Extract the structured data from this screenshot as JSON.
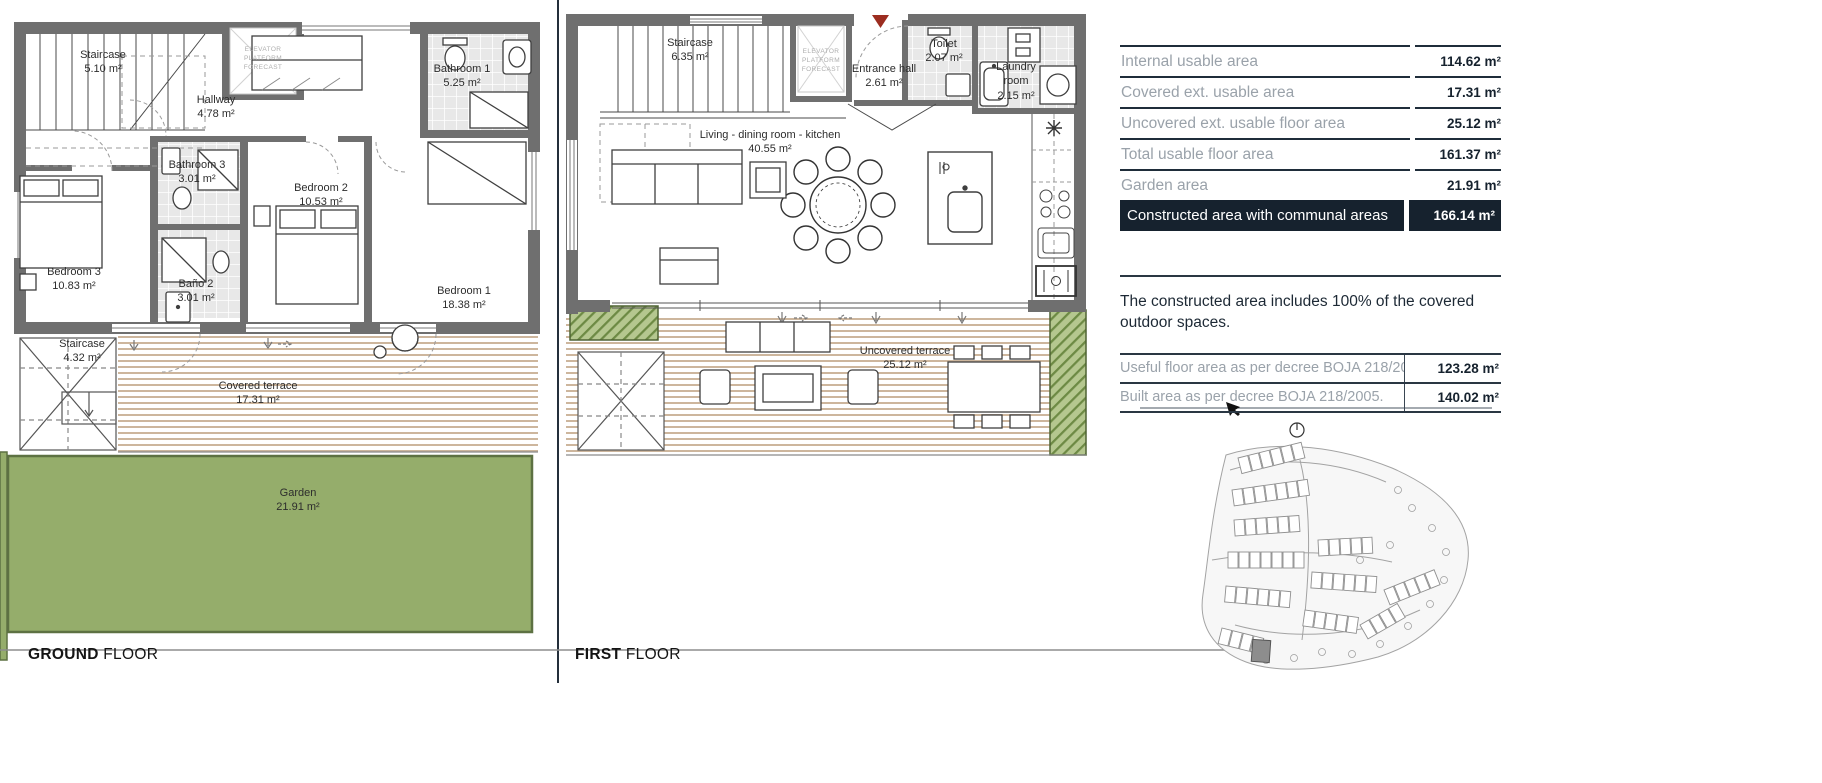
{
  "colors": {
    "navy": "#16222e",
    "table_label_gray": "#9aa2aa",
    "wall_gray": "#6f6f6f",
    "deck_tan": "#cdb69d",
    "garden_green": "#95ad6b",
    "planter_green": "#6d8a44",
    "marker_red": "#9c2d20"
  },
  "ground_floor": {
    "title": {
      "bold": "GROUND",
      "regular": " FLOOR"
    },
    "elevator_note": "ELEVATOR\nPLATFORM\nFORECAST",
    "rooms": [
      {
        "name": "Staircase",
        "area": "5.10 m²"
      },
      {
        "name": "Hallway",
        "area": "4.78 m²"
      },
      {
        "name": "Bathroom 1",
        "area": "5.25 m²"
      },
      {
        "name": "Bathroom 3",
        "area": "3.01 m²"
      },
      {
        "name": "Bedroom 2",
        "area": "10.53 m²"
      },
      {
        "name": "Bedroom 3",
        "area": "10.83 m²"
      },
      {
        "name": "Baño 2",
        "area": "3.01 m²"
      },
      {
        "name": "Bedroom 1",
        "area": "18.38 m²"
      },
      {
        "name": "Staircase",
        "area": "4.32 m²"
      },
      {
        "name": "Covered terrace",
        "area": "17.31 m²"
      },
      {
        "name": "Garden",
        "area": "21.91 m²"
      }
    ]
  },
  "first_floor": {
    "title": {
      "bold": "FIRST",
      "regular": " FLOOR"
    },
    "elevator_note": "ELEVATOR\nPLATFORM\nFORECAST",
    "rooms": [
      {
        "name": "Staircase",
        "area": "6.35 m²"
      },
      {
        "name": "Entrance hall",
        "area": "2.61 m²"
      },
      {
        "name": "Toilet",
        "area": "2.07 m²"
      },
      {
        "name": "Laundry room",
        "area": "2.15 m²"
      },
      {
        "name": "Living - dining room - kitchen",
        "area": "40.55 m²"
      },
      {
        "name": "Uncovered terrace",
        "area": "25.12 m²"
      }
    ]
  },
  "panel": {
    "areas_table": [
      {
        "label": "Internal usable area",
        "value": "114.62 m²"
      },
      {
        "label": "Covered ext. usable area",
        "value": "17.31 m²"
      },
      {
        "label": "Uncovered ext. usable floor area",
        "value": "25.12 m²"
      },
      {
        "label": "Total usable floor area",
        "value": "161.37 m²"
      },
      {
        "label": "Garden area",
        "value": "21.91 m²"
      },
      {
        "label": "Constructed area with communal areas",
        "value": "166.14 m²"
      }
    ],
    "note": "The constructed area includes 100% of the covered outdoor spaces.",
    "decree_table": [
      {
        "label": "Useful floor area as per decree BOJA 218/2005.",
        "value": "123.28 m²"
      },
      {
        "label": "Built area as per decree BOJA 218/2005.",
        "value": "140.02 m²"
      }
    ]
  }
}
